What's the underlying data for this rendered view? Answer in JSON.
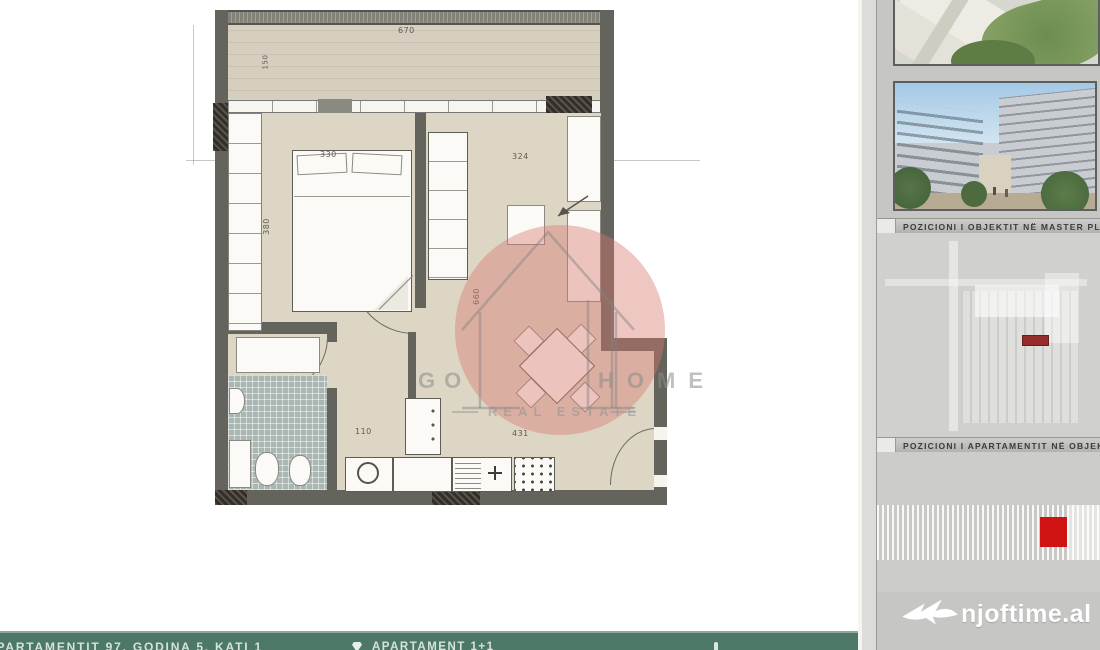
{
  "plan": {
    "dims": {
      "balcony_width": "670",
      "balcony_depth": "150",
      "bedroom_width": "330",
      "bedroom_depth": "380",
      "living_width": "324",
      "living_depth": "660",
      "kitchen_nook": "110",
      "kitchen_run": "431"
    }
  },
  "watermark": {
    "brand_left": "GO",
    "brand_right": "HOME",
    "tagline": "REAL ESTATE"
  },
  "sidebar": {
    "caption_masterplan": "POZICIONI I OBJEKTIT NË MASTER PLAN",
    "caption_apartment": "POZICIONI I APARTAMENTIT NË OBJEKT",
    "logo": "njoftime.al"
  },
  "bottom_bar": {
    "left_label": "APARTAMENTIT 97, GODINA 5, KATI 1",
    "apartment_type": "APARTAMENT 1+1"
  },
  "colors": {
    "bar_green": "#4d7867",
    "marker_red": "#cf1212",
    "masterplan_red": "#942c2c",
    "watermark_pink": "rgba(214,120,110,0.42)"
  }
}
